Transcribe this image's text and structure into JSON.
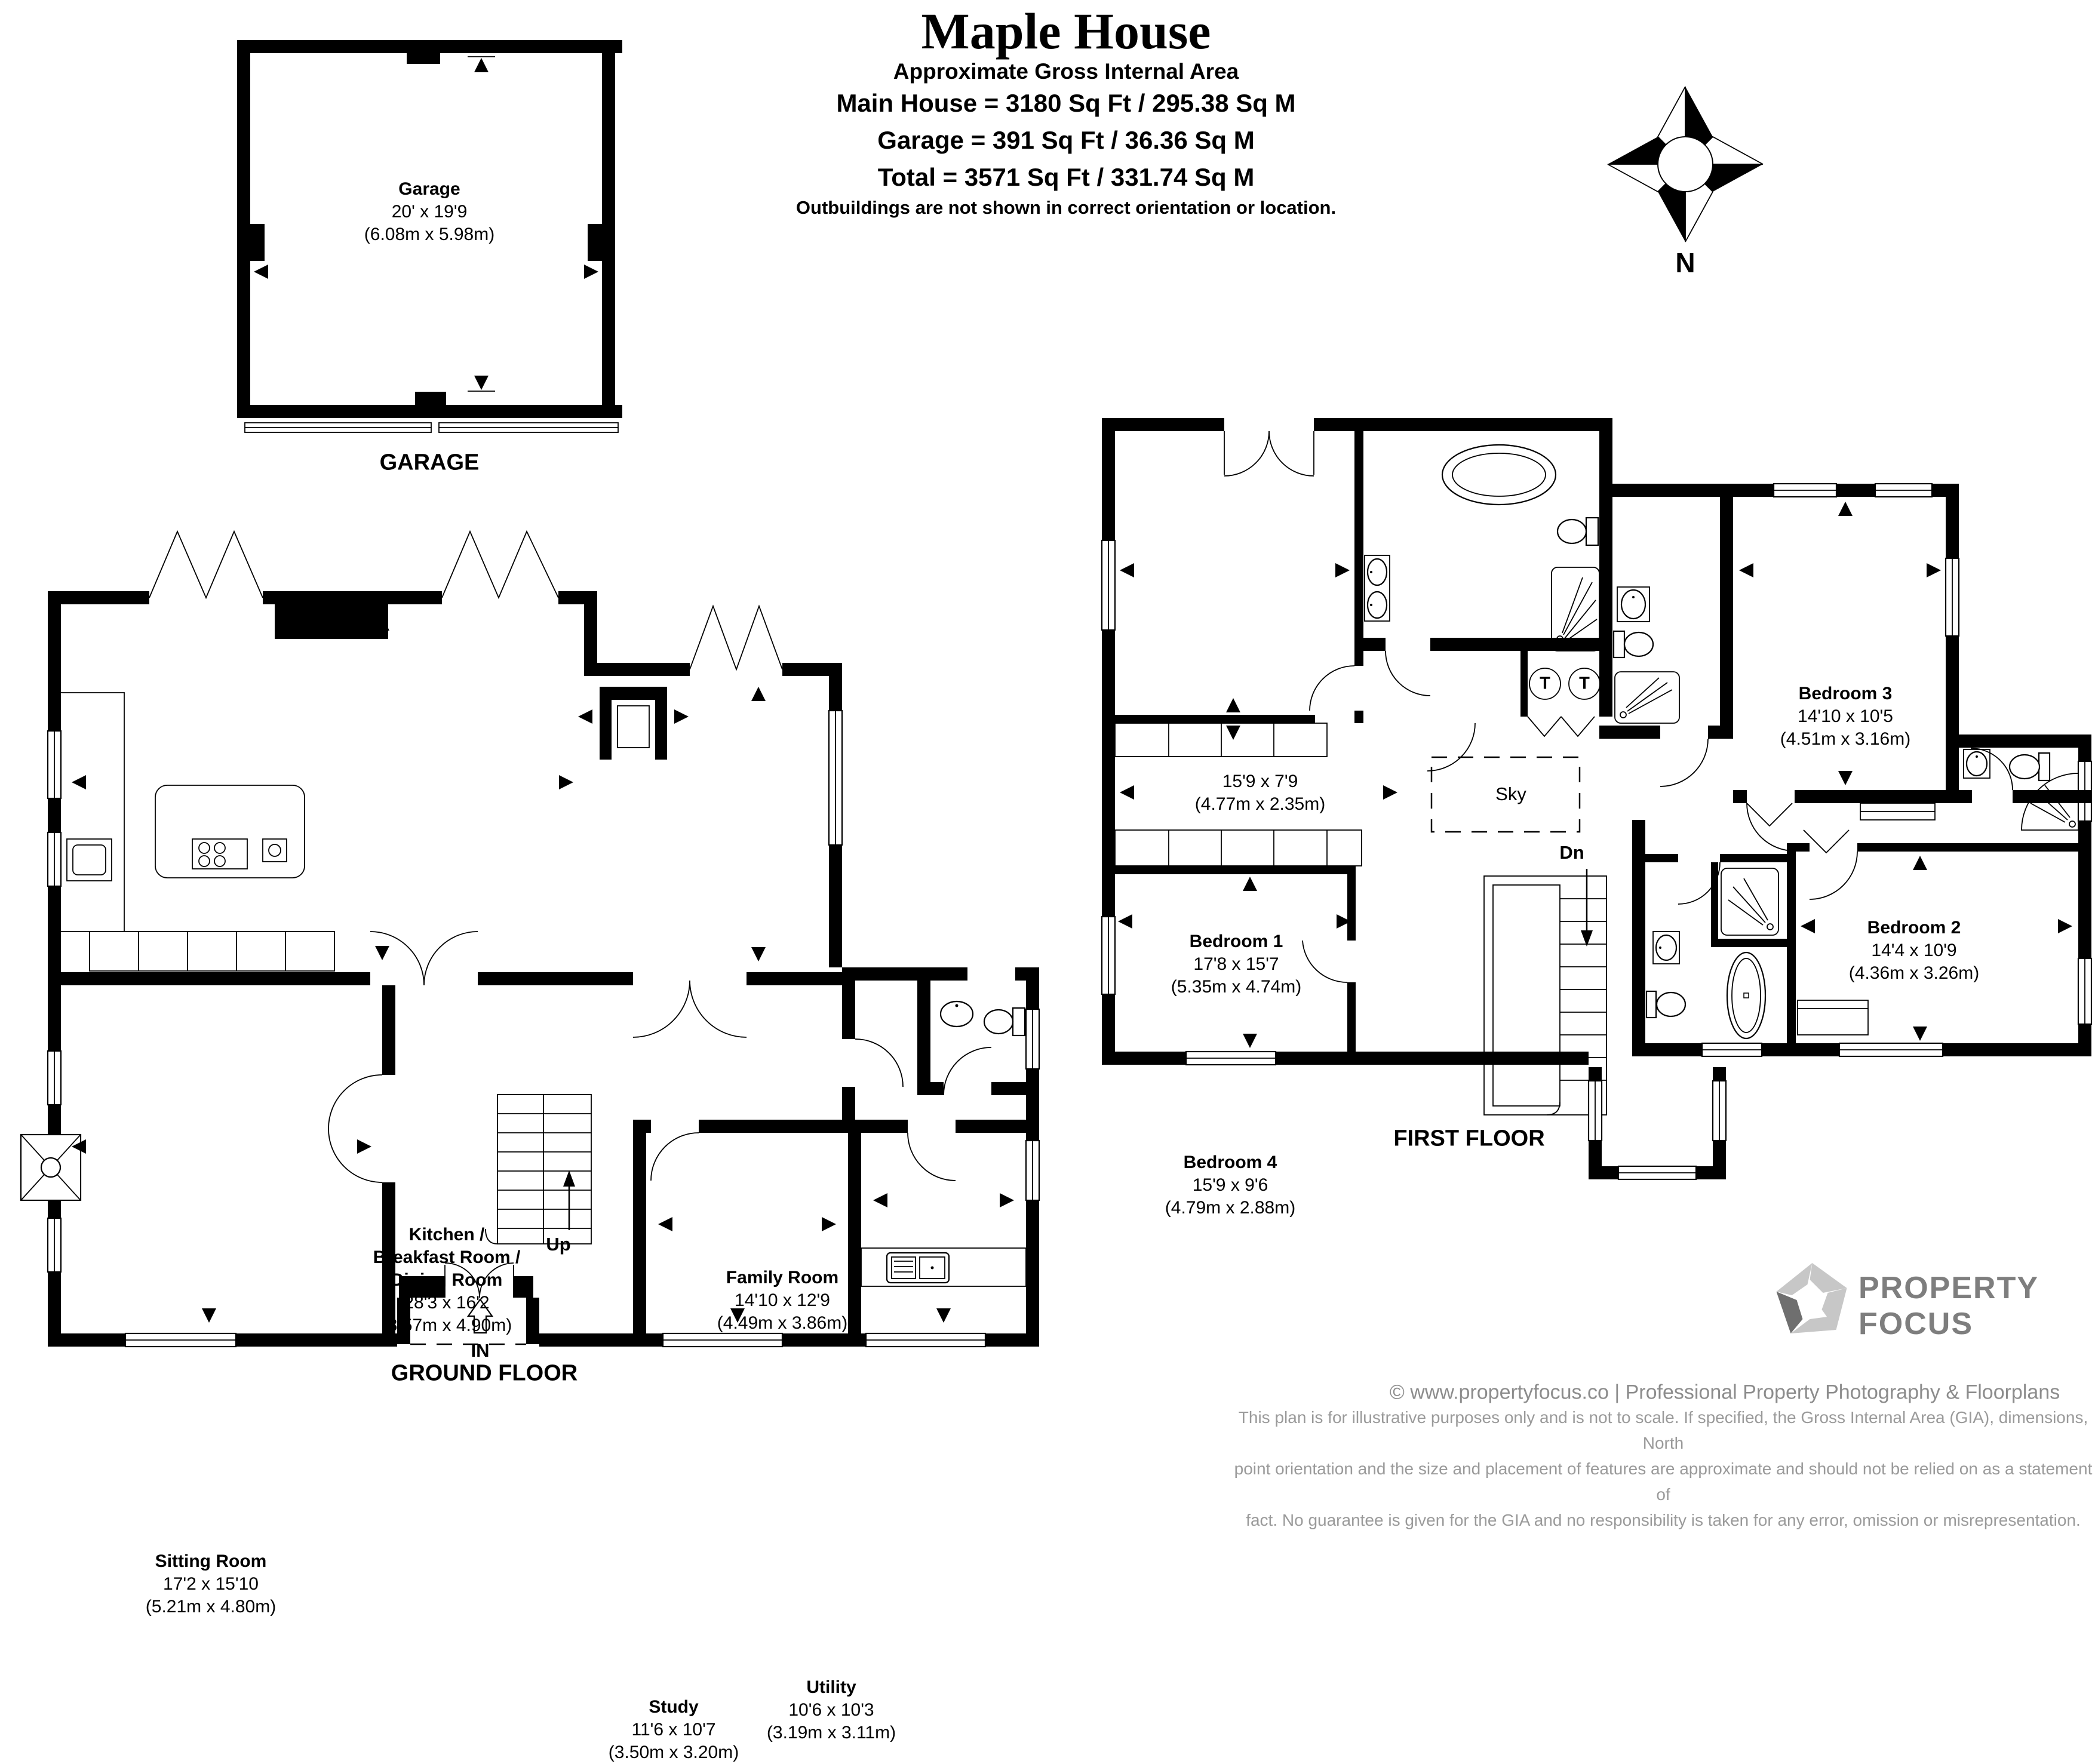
{
  "header": {
    "title": "Maple House",
    "subtitle": "Approximate Gross Internal Area",
    "line_main": "Main House = 3180 Sq Ft / 295.38 Sq M",
    "line_garage": "Garage = 391 Sq Ft / 36.36 Sq M",
    "line_total": "Total = 3571 Sq Ft / 331.74 Sq M",
    "note": "Outbuildings are not shown in correct orientation or location."
  },
  "compass": {
    "north_label": "N"
  },
  "garage": {
    "room": {
      "name": "Garage",
      "dims_ft": "20' x 19'9",
      "dims_m": "(6.08m x 5.98m)"
    },
    "caption": "GARAGE"
  },
  "ground_floor": {
    "caption": "GROUND FLOOR",
    "stairs_label": "Up",
    "entrance_label": "IN",
    "rooms": {
      "kitchen": {
        "line1": "Kitchen /",
        "line2": "Breakfast Room /",
        "line3": "Dining Room",
        "dims_ft": "28'3 x 16'2",
        "dims_m": "(8.57m x 4.90m)"
      },
      "family": {
        "name": "Family Room",
        "dims_ft": "14'10 x 12'9",
        "dims_m": "(4.49m x 3.86m)"
      },
      "sitting": {
        "name": "Sitting Room",
        "dims_ft": "17'2 x 15'10",
        "dims_m": "(5.21m x 4.80m)"
      },
      "study": {
        "name": "Study",
        "dims_ft": "11'6 x 10'7",
        "dims_m": "(3.50m x 3.20m)"
      },
      "utility": {
        "name": "Utility",
        "dims_ft": "10'6 x 10'3",
        "dims_m": "(3.19m x 3.11m)"
      }
    }
  },
  "first_floor": {
    "caption": "FIRST FLOOR",
    "stairs_label": "Dn",
    "skylight_label": "Sky",
    "tank_label": "T",
    "rooms": {
      "bedroom1": {
        "name": "Bedroom 1",
        "dims_ft": "17'8 x 15'7",
        "dims_m": "(5.35m x 4.74m)"
      },
      "dressing": {
        "dims_ft": "15'9 x 7'9",
        "dims_m": "(4.77m x 2.35m)"
      },
      "bedroom3": {
        "name": "Bedroom 3",
        "dims_ft": "14'10 x 10'5",
        "dims_m": "(4.51m x 3.16m)"
      },
      "bedroom4": {
        "name": "Bedroom 4",
        "dims_ft": "15'9 x 9'6",
        "dims_m": "(4.79m x 2.88m)"
      },
      "bedroom2": {
        "name": "Bedroom 2",
        "dims_ft": "14'4 x 10'9",
        "dims_m": "(4.36m x 3.26m)"
      }
    }
  },
  "footer": {
    "brand_line1": "PROPERTY",
    "brand_line2": "FOCUS",
    "credit": "© www.propertyfocus.co | Professional Property Photography & Floorplans",
    "disclaimer1": "This plan is for illustrative purposes only and is not to scale. If specified, the Gross Internal Area (GIA), dimensions, North",
    "disclaimer2": "point orientation and the size and placement of features are approximate and should not be relied on as a statement of",
    "disclaimer3": "fact. No guarantee is given for the GIA and no responsibility is taken for any error, omission or misrepresentation."
  }
}
